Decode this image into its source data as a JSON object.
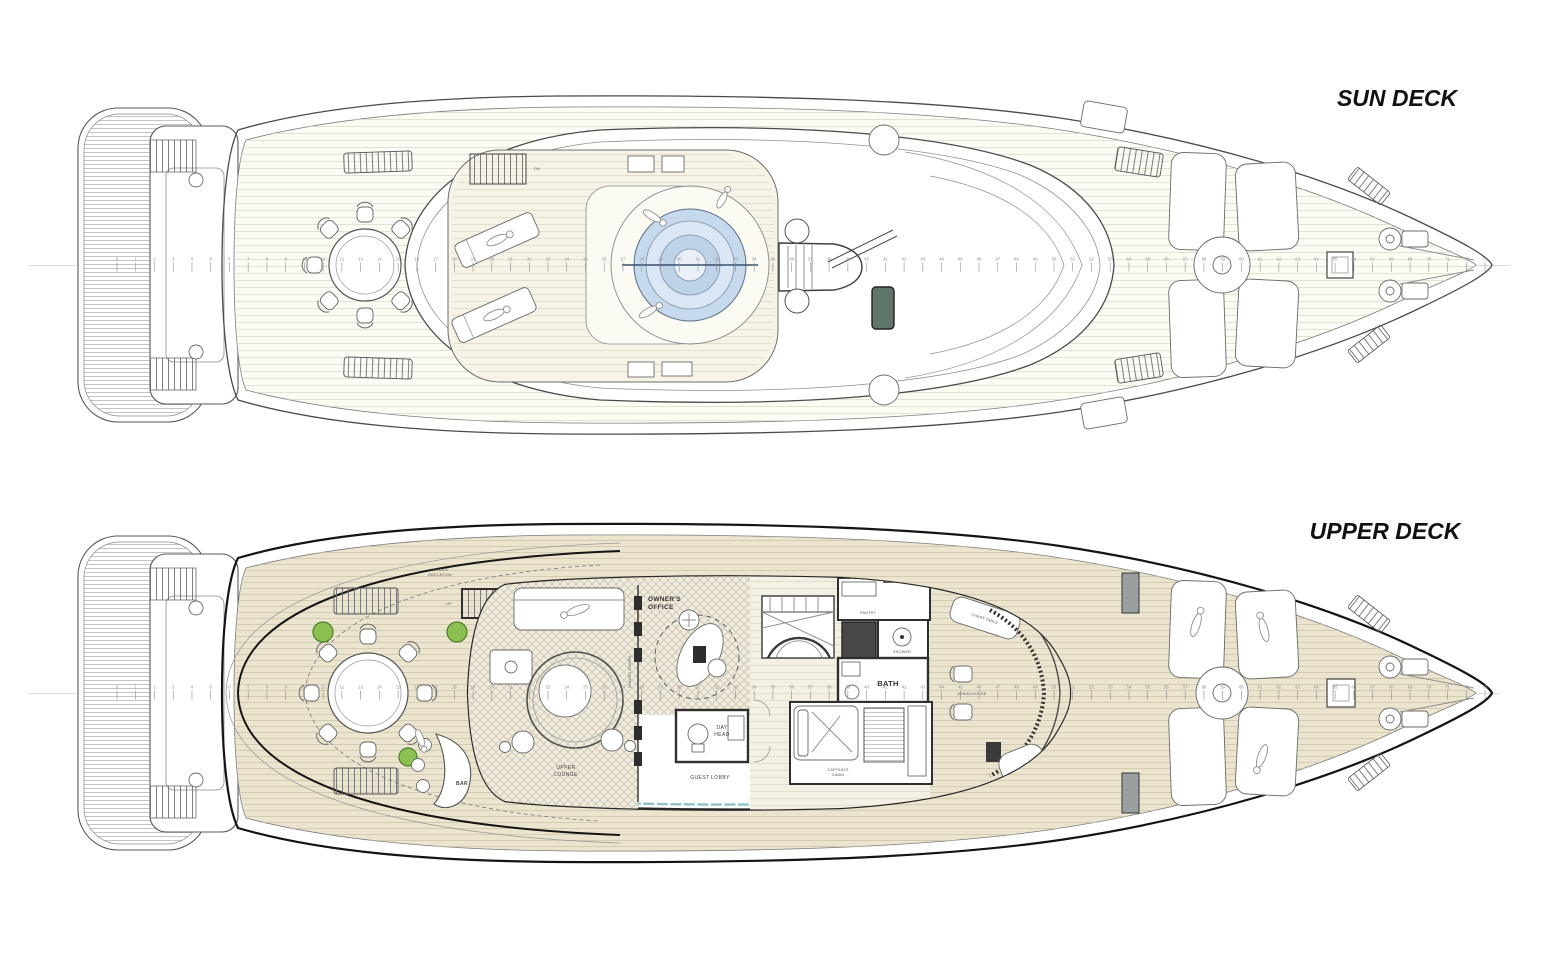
{
  "sun_deck": {
    "title": "SUN DECK",
    "labels": {
      "stairs_down": "DN"
    }
  },
  "upper_deck": {
    "title": "UPPER DECK",
    "rooms": {
      "owners_office_1": "OWNER'S",
      "owners_office_2": "OFFICE",
      "upper_lounge_1": "UPPER",
      "upper_lounge_2": "LOUNGE",
      "guest_lobby": "GUEST LOBBY",
      "day_head_1": "DAY",
      "day_head_2": "HEAD",
      "bath": "BATH",
      "bar": "BAR",
      "pantry": "PANTRY",
      "shower": "SHOWER",
      "wheelhouse": "WHEELHOUSE",
      "chart_table": "CHART TABLE",
      "captains_cabin_1": "CAPTAIN'S",
      "captains_cabin_2": "CABIN"
    },
    "labels": {
      "privacy_1": "PRIVACY",
      "privacy_2": "INDICATION",
      "sliding_doors": "SLIDING DOORS",
      "stairs_up": "UP",
      "dumbwaiter": "DB"
    }
  },
  "frame_ruler": {
    "start": 0,
    "end": 73
  },
  "colors": {
    "jacuzzi": "#c7d9ec",
    "jacuzzi_mid": "#dbe7f4",
    "jacuzzi_deep": "#bfd3e8",
    "window_band": "#8fc0ca",
    "skylight": "#5f7567",
    "plant": "#8cc152",
    "plant_edge": "#4e7c2a",
    "deck_sun": "#f7f3e6",
    "deck_upper": "#ebe5d0",
    "hull_line": "#4a4a4a"
  }
}
